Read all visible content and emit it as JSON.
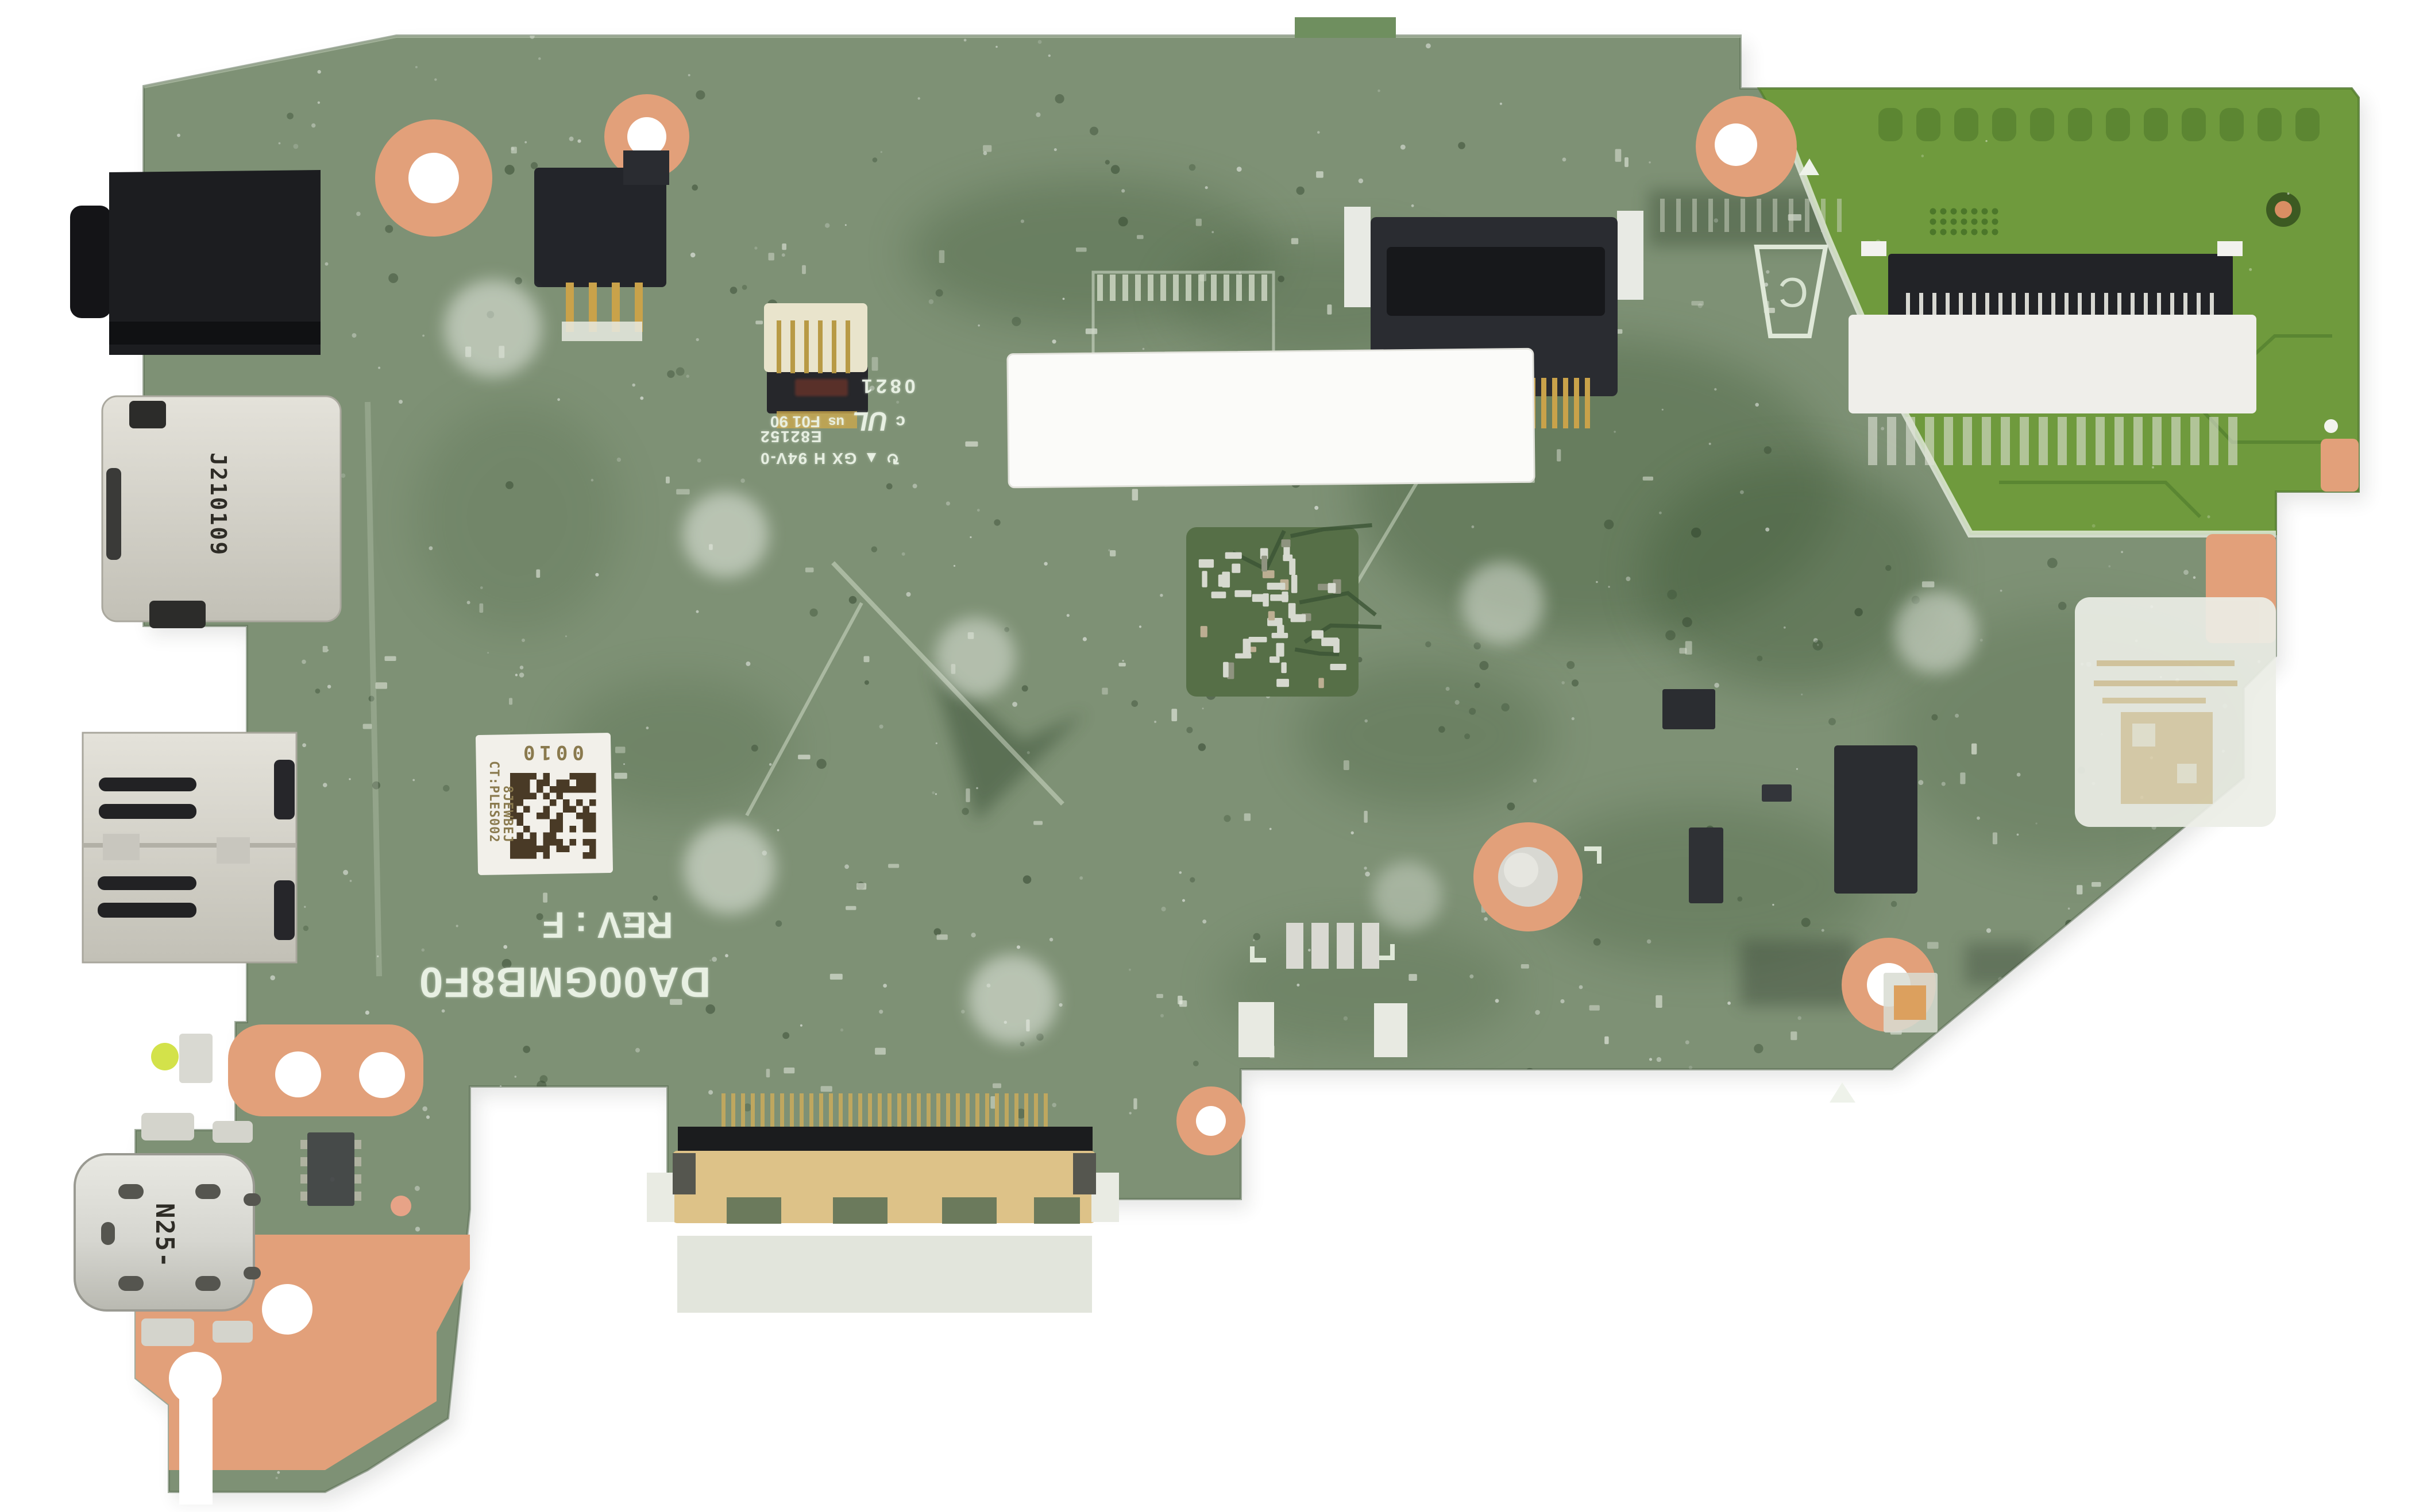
{
  "scene": {
    "type": "photograph",
    "subject": "laptop motherboard top view on white background",
    "background_color": "#ffffff"
  },
  "silkscreen": {
    "model": "DA00GMB8F0",
    "revision": "REV : F",
    "sd_slot_designator": "J210109",
    "usb_c_designator": "N25-",
    "date_code": "0821",
    "ul_mark_c": "c",
    "ul_mark_core": "UL",
    "ul_mark_us": "us",
    "ul_line": "F01 90",
    "ul_file_number": "E82152",
    "rating_symbols": "↻ ▲",
    "flammability_rating": "GX H 94V-0",
    "trapezoid_letter": "C"
  },
  "sticker": {
    "serial": "0010",
    "ct_code": "CT:PLES002",
    "line2": "8JEWBEJ"
  },
  "colors": {
    "board_film": "#7e9175",
    "board_bare": "#6f9a3d",
    "copper": "#e2a07a",
    "gold": "#c9a24a",
    "silver": "#d8d8d2",
    "black_connector": "#232528"
  }
}
